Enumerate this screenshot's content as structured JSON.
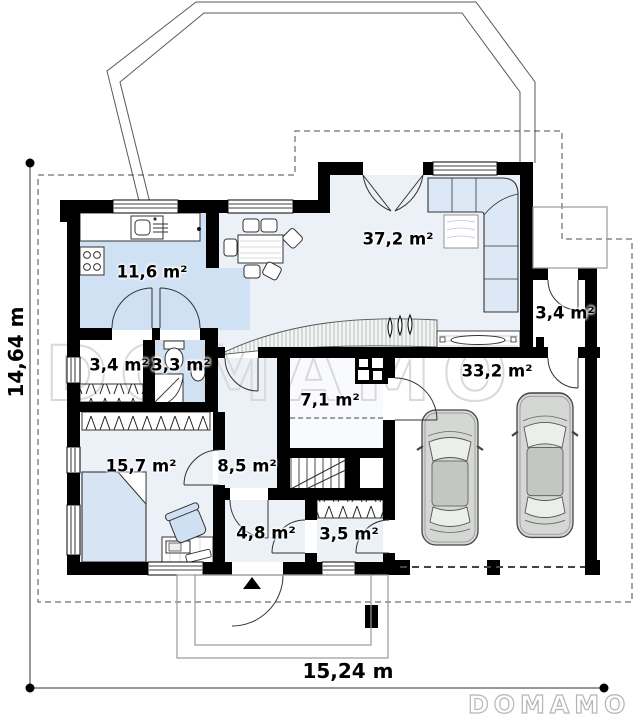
{
  "watermark_text": "DOMAMO",
  "brand_logo": "DOMAMO",
  "dimensions": {
    "total_width": "15,24 m",
    "total_height": "14,64 m"
  },
  "rooms": [
    {
      "id": "kitchen",
      "area": "11,6 m²"
    },
    {
      "id": "living-room",
      "area": "37,2 m²"
    },
    {
      "id": "wardrobe",
      "area": "3,4 m²"
    },
    {
      "id": "bathroom",
      "area": "3,3 m²"
    },
    {
      "id": "vestibule",
      "area": "3,4 m²"
    },
    {
      "id": "boiler-room",
      "area": "7,1 m²"
    },
    {
      "id": "garage",
      "area": "33,2 m²"
    },
    {
      "id": "bedroom",
      "area": "15,7 m²"
    },
    {
      "id": "hall",
      "area": "8,5 m²"
    },
    {
      "id": "entry",
      "area": "4,8 m²"
    },
    {
      "id": "closet",
      "area": "3,5 m²"
    }
  ],
  "colors": {
    "wall": "#000000",
    "room_fill": "#ecf1f8",
    "kitchen_fill": "#cfe1f3",
    "furniture_fill": "#d6e4f4",
    "car_fill": "#d5d7d4",
    "watermark": "#d9d9d9"
  }
}
